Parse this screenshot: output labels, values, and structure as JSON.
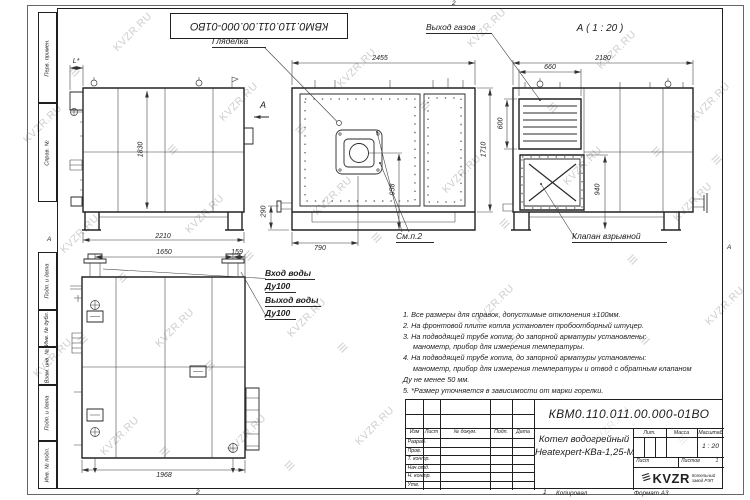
{
  "watermark": {
    "text": "KVZR.RU",
    "glyph": "≡"
  },
  "border": {
    "top_doc_number": "КВМ0.110.011.00.000-01ВО",
    "strips": [
      "Перв. примен.",
      "Справ. №",
      "Подп. и дата",
      "Инв. № дубл.",
      "Взам. инв. №",
      "Подп. и дата",
      "Инв. № подл."
    ],
    "zone_top": "2",
    "zone_bottom_left": "2",
    "zone_bottom_right": "1",
    "zone_left": "А",
    "zone_right": "А",
    "copied": "Копировал",
    "format": "Формат А3"
  },
  "labels": {
    "sight": "Гляделка",
    "gas": "Выход газов",
    "valve": "Клапан взрывной",
    "see_note": "См.п.2",
    "water_in": "Вход воды",
    "water_in_dn": "Ду100",
    "water_out": "Выход воды",
    "water_out_dn": "Ду100",
    "view_a_title": "А ( 1 : 20 )",
    "section_arrow": "А"
  },
  "dims": {
    "l_star": "L*",
    "h1830": "1830",
    "w2210": "2210",
    "w2455": "2455",
    "h1710": "1710",
    "h958": "958",
    "w790": "790",
    "h290": "290",
    "w2180": "2180",
    "w660": "660",
    "h600": "600",
    "h940": "940",
    "w1650": "1650",
    "w159": "159",
    "w1968": "1968"
  },
  "notes": [
    "1. Все размеры для справок, допустимые отклонения ±100мм.",
    "2. На фронтовой плите котла установлен пробоотборный штуцер.",
    "3. На подводящей трубе котла, до запорной арматуры установлены:",
    "манометр, прибор для измерения температуры.",
    "4. На подводящей трубе котла, до запорной арматуры установлены:",
    "манометр, прибор для измерения температуры и отвод с обратным клапаном",
    "Ду не менее 50 мм.",
    "5. *Размер уточняется в зависимости от марки горелки."
  ],
  "title_block": {
    "doc_number": "КВМ0.110.011.00.000-01ВО",
    "product_line1": "Котел водогрейный",
    "product_line2": "Heatexpert-КВа-1,25-М",
    "cols": [
      "Изм",
      "Лист",
      "№ докум.",
      "Подп.",
      "Дата"
    ],
    "rows": [
      "Разраб.",
      "Пров.",
      "Т. контр.",
      "Нач.отд.",
      "Н. контр.",
      "Утв."
    ],
    "lit_label": "Лит.",
    "mass_label": "Масса",
    "scale_label": "Масштаб",
    "scale_value": "1 : 20",
    "sheet_label": "Лист",
    "sheets_label": "Листов",
    "sheets_value": "1",
    "company": {
      "logo": "KVZR",
      "sub1": "Котельный",
      "sub2": "завод РЭП"
    }
  }
}
